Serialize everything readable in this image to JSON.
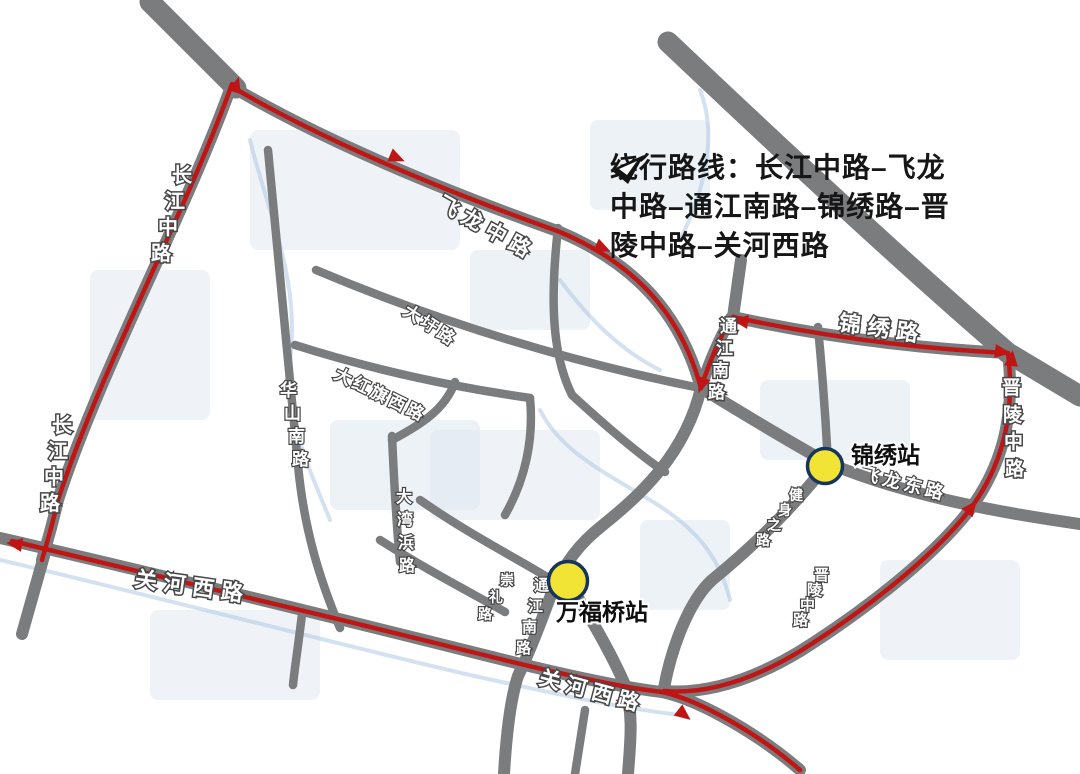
{
  "legend": {
    "icon": "detour-arrow-icon",
    "lines": [
      "绕行路线：长江中路–飞龙",
      "中路–通江南路–锦绣路–晋",
      "陵中路–关河西路"
    ]
  },
  "stations": [
    {
      "name": "锦绣站",
      "cx": 825,
      "cy": 466,
      "r": 17.5,
      "label_x": 851,
      "label_y": 463,
      "label_size": 23
    },
    {
      "name": "万福桥站",
      "cx": 568,
      "cy": 581,
      "r": 19.5,
      "label_x": 556,
      "label_y": 620,
      "label_size": 23
    }
  ],
  "road_labels": [
    {
      "text": "长江中路",
      "mode": "stacked",
      "x": 172,
      "y": 182,
      "dx": -7,
      "dy": 26,
      "size": 20
    },
    {
      "text": "长江中路",
      "mode": "stacked",
      "x": 52,
      "y": 432,
      "dx": -4,
      "dy": 26,
      "size": 20
    },
    {
      "text": "飞龙中路",
      "mode": "rotated",
      "x": 436,
      "y": 208,
      "angle": 29,
      "size": 21,
      "spacing": 6
    },
    {
      "text": "大圩路",
      "mode": "rotated",
      "x": 402,
      "y": 314,
      "angle": 33,
      "size": 17,
      "spacing": 3,
      "minor": true
    },
    {
      "text": "大红旗西路",
      "mode": "rotated",
      "x": 333,
      "y": 378,
      "angle": 26,
      "size": 17,
      "spacing": 3,
      "minor": true
    },
    {
      "text": "华山南路",
      "mode": "stacked",
      "x": 280,
      "y": 396,
      "dx": 4,
      "dy": 23,
      "size": 17,
      "minor": true
    },
    {
      "text": "大湾浜路",
      "mode": "stacked",
      "x": 396,
      "y": 502,
      "dx": 1,
      "dy": 23,
      "size": 16,
      "minor": true
    },
    {
      "text": "通江南路",
      "mode": "stacked",
      "x": 720,
      "y": 332,
      "dx": -4,
      "dy": 22,
      "size": 17
    },
    {
      "text": "锦绣路",
      "mode": "rotated",
      "x": 838,
      "y": 330,
      "angle": 8,
      "size": 22,
      "spacing": 7
    },
    {
      "text": "晋陵中路",
      "mode": "stacked",
      "x": 1002,
      "y": 394,
      "dx": 1,
      "dy": 27,
      "size": 19
    },
    {
      "text": "飞龙东路",
      "mode": "rotated",
      "x": 860,
      "y": 479,
      "angle": 14,
      "size": 18,
      "spacing": 4,
      "minor": true
    },
    {
      "text": "健身之路",
      "mode": "stacked",
      "x": 789,
      "y": 500,
      "dx": -11,
      "dy": 15,
      "size": 14,
      "minor": true
    },
    {
      "text": "晋陵中路",
      "mode": "stacked",
      "x": 814,
      "y": 580,
      "dx": -7,
      "dy": 15,
      "size": 15,
      "minor": true
    },
    {
      "text": "通江南路",
      "mode": "stacked",
      "x": 534,
      "y": 590,
      "dx": -6,
      "dy": 21,
      "size": 15,
      "minor": true
    },
    {
      "text": "崇礼路",
      "mode": "stacked",
      "x": 500,
      "y": 585,
      "dx": -11,
      "dy": 17,
      "size": 14,
      "minor": true
    },
    {
      "text": "关河西路",
      "mode": "rotated",
      "x": 134,
      "y": 586,
      "angle": 8,
      "size": 22,
      "spacing": 7
    },
    {
      "text": "关河西路",
      "mode": "rotated",
      "x": 538,
      "y": 684,
      "angle": 15,
      "size": 21,
      "spacing": 6
    }
  ],
  "colors": {
    "detour_red": "#c01515",
    "road_gray": "#7b7c7e",
    "station_fill": "#f2e434",
    "station_border": "#17345c",
    "label_white": "#ffffff"
  }
}
